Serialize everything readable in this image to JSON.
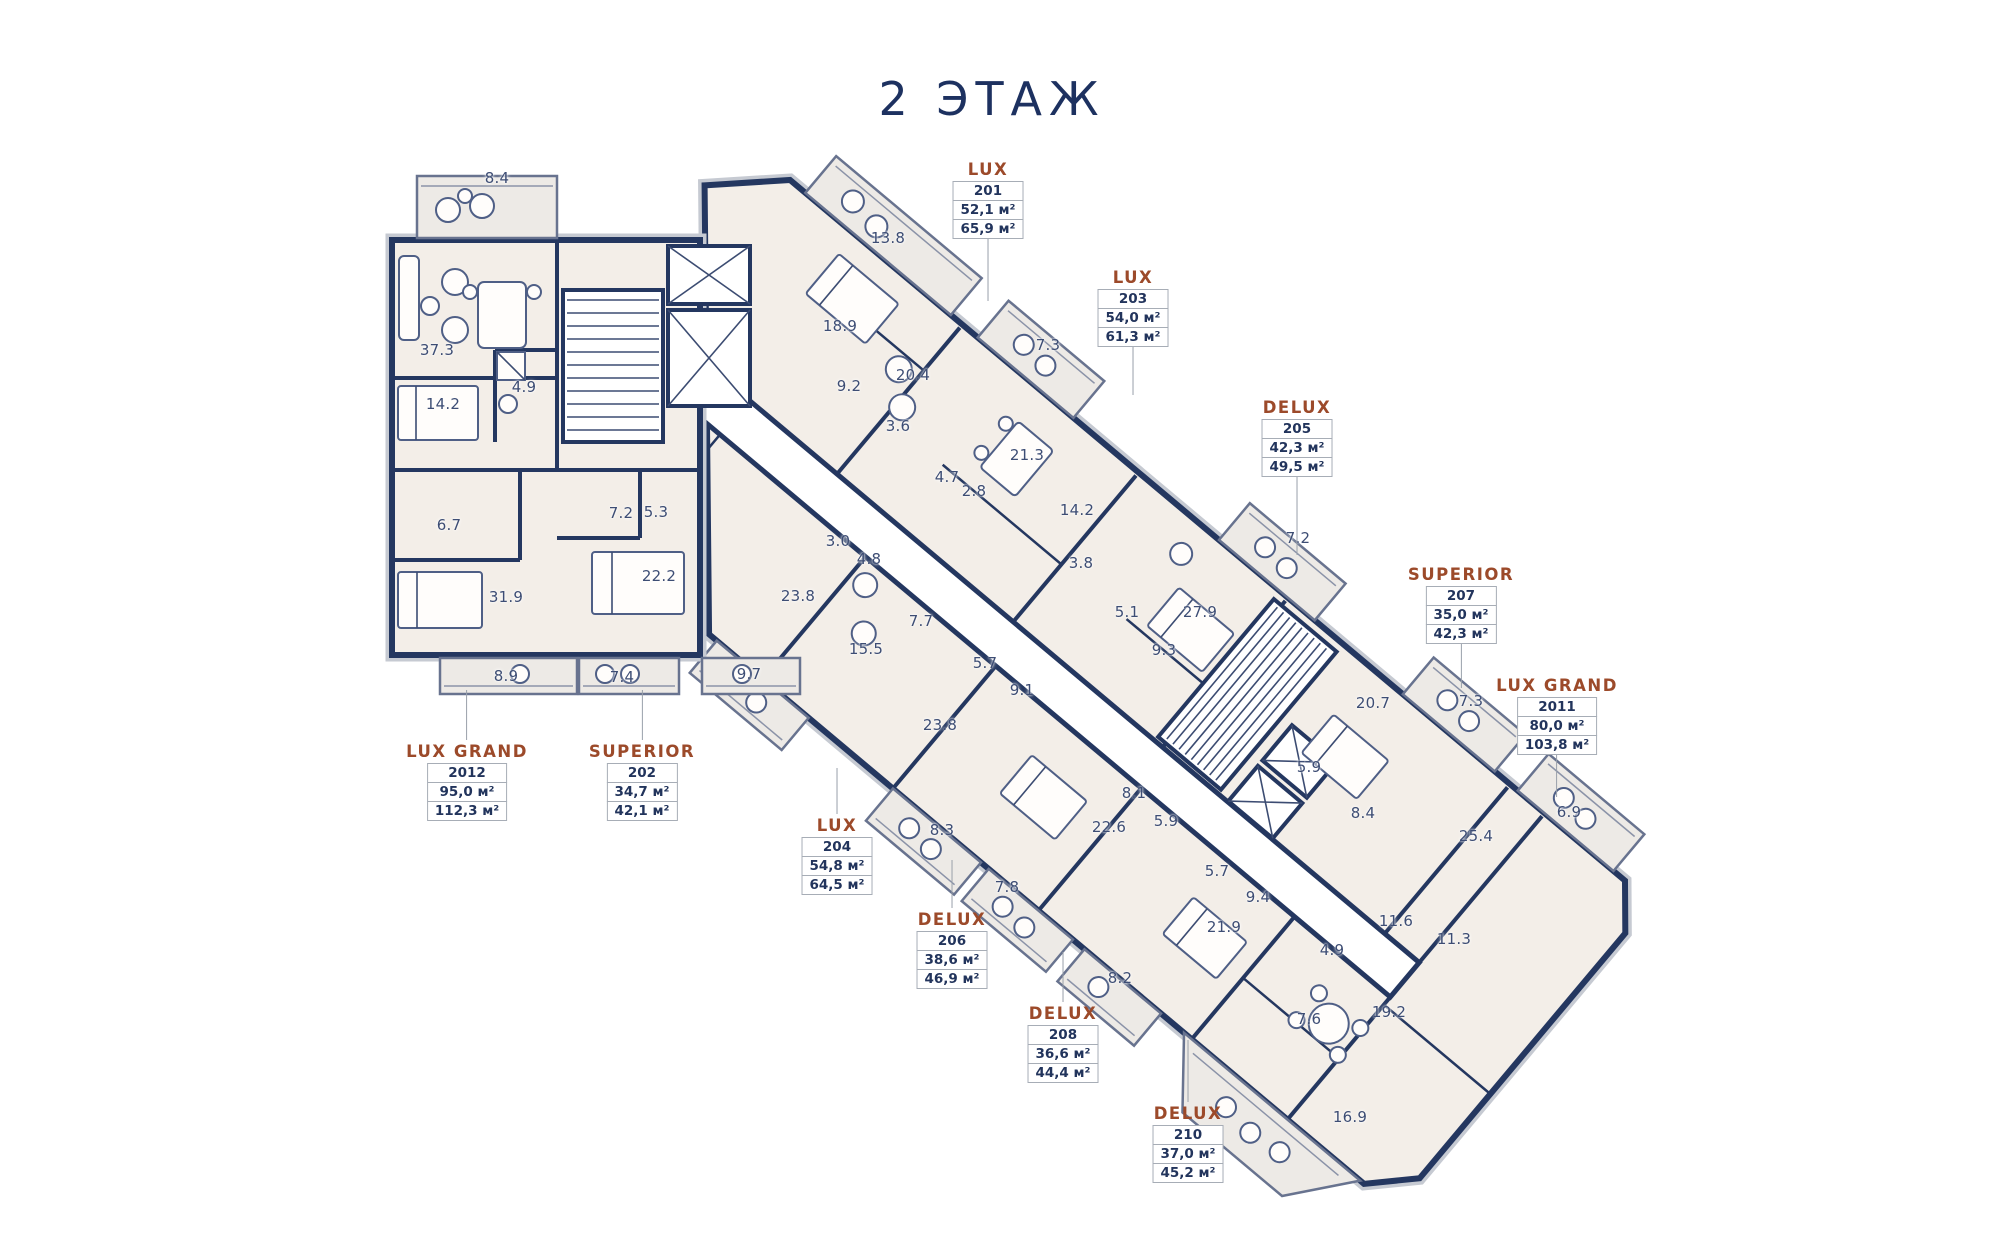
{
  "title": "2 ЭТАЖ",
  "plan": {
    "colors": {
      "wall_navy": "#243760",
      "room_fill": "#f3eee8",
      "balcony_fill": "#edeae6",
      "corridor_fill": "#ffffff",
      "unit_type_brown": "#9c4a2a",
      "number_navy": "#22345c",
      "leader_gray": "#99a0aa"
    },
    "units": [
      {
        "type": "LUX",
        "number": "201",
        "area1": "52,1 м²",
        "area2": "65,9 м²",
        "cx": 988,
        "top": 158,
        "dir": "down",
        "leader": 62
      },
      {
        "type": "LUX",
        "number": "203",
        "area1": "54,0 м²",
        "area2": "61,3 м²",
        "cx": 1133,
        "top": 266,
        "dir": "down",
        "leader": 48
      },
      {
        "type": "DELUX",
        "number": "205",
        "area1": "42,3 м²",
        "area2": "49,5 м²",
        "cx": 1297,
        "top": 396,
        "dir": "down",
        "leader": 78
      },
      {
        "type": "SUPERIOR",
        "number": "207",
        "area1": "35,0 м²",
        "area2": "42,3 м²",
        "cx": 1461,
        "top": 563,
        "dir": "down",
        "leader": 44
      },
      {
        "type": "LUX GRAND",
        "number": "2011",
        "area1": "80,0 м²",
        "area2": "103,8 м²",
        "cx": 1557,
        "top": 674,
        "dir": "down",
        "leader": 42
      },
      {
        "type": "LUX GRAND",
        "number": "2012",
        "area1": "95,0 м²",
        "area2": "112,3 м²",
        "cx": 467,
        "top": 690,
        "dir": "up",
        "leader": 50
      },
      {
        "type": "SUPERIOR",
        "number": "202",
        "area1": "34,7 м²",
        "area2": "42,1 м²",
        "cx": 642,
        "top": 690,
        "dir": "up",
        "leader": 50
      },
      {
        "type": "LUX",
        "number": "204",
        "area1": "54,8 м²",
        "area2": "64,5 м²",
        "cx": 837,
        "top": 768,
        "dir": "up",
        "leader": 46
      },
      {
        "type": "DELUX",
        "number": "206",
        "area1": "38,6 м²",
        "area2": "46,9 м²",
        "cx": 952,
        "top": 860,
        "dir": "up",
        "leader": 48
      },
      {
        "type": "DELUX",
        "number": "208",
        "area1": "36,6 м²",
        "area2": "44,4 м²",
        "cx": 1063,
        "top": 952,
        "dir": "up",
        "leader": 50
      },
      {
        "type": "DELUX",
        "number": "210",
        "area1": "37,0 м²",
        "area2": "45,2 м²",
        "cx": 1188,
        "top": 1040,
        "dir": "up",
        "leader": 62
      }
    ],
    "rooms": [
      {
        "v": "8.4",
        "x": 497,
        "y": 178
      },
      {
        "v": "37.3",
        "x": 437,
        "y": 350
      },
      {
        "v": "14.2",
        "x": 443,
        "y": 404
      },
      {
        "v": "4.9",
        "x": 524,
        "y": 387
      },
      {
        "v": "6.7",
        "x": 449,
        "y": 525
      },
      {
        "v": "31.9",
        "x": 506,
        "y": 597
      },
      {
        "v": "8.9",
        "x": 506,
        "y": 676
      },
      {
        "v": "7.2",
        "x": 621,
        "y": 513
      },
      {
        "v": "5.3",
        "x": 656,
        "y": 512
      },
      {
        "v": "22.2",
        "x": 659,
        "y": 576
      },
      {
        "v": "7.4",
        "x": 622,
        "y": 677
      },
      {
        "v": "9.7",
        "x": 749,
        "y": 674
      },
      {
        "v": "13.8",
        "x": 888,
        "y": 238
      },
      {
        "v": "18.9",
        "x": 840,
        "y": 326
      },
      {
        "v": "9.2",
        "x": 849,
        "y": 386
      },
      {
        "v": "20.4",
        "x": 913,
        "y": 375
      },
      {
        "v": "3.6",
        "x": 898,
        "y": 426
      },
      {
        "v": "7.3",
        "x": 1048,
        "y": 345
      },
      {
        "v": "21.3",
        "x": 1027,
        "y": 455
      },
      {
        "v": "4.7",
        "x": 947,
        "y": 477
      },
      {
        "v": "2.8",
        "x": 974,
        "y": 491
      },
      {
        "v": "14.2",
        "x": 1077,
        "y": 510
      },
      {
        "v": "3.8",
        "x": 1081,
        "y": 563
      },
      {
        "v": "3.0",
        "x": 838,
        "y": 541
      },
      {
        "v": "4.8",
        "x": 869,
        "y": 559
      },
      {
        "v": "7.7",
        "x": 921,
        "y": 621
      },
      {
        "v": "15.5",
        "x": 866,
        "y": 649
      },
      {
        "v": "23.8",
        "x": 798,
        "y": 596
      },
      {
        "v": "5.7",
        "x": 985,
        "y": 663
      },
      {
        "v": "9.1",
        "x": 1022,
        "y": 690
      },
      {
        "v": "23.8",
        "x": 940,
        "y": 725
      },
      {
        "v": "5.1",
        "x": 1127,
        "y": 612
      },
      {
        "v": "9.3",
        "x": 1164,
        "y": 650
      },
      {
        "v": "27.9",
        "x": 1200,
        "y": 612
      },
      {
        "v": "7.2",
        "x": 1298,
        "y": 538
      },
      {
        "v": "20.7",
        "x": 1373,
        "y": 703
      },
      {
        "v": "7.3",
        "x": 1471,
        "y": 701
      },
      {
        "v": "5.9",
        "x": 1309,
        "y": 767
      },
      {
        "v": "8.4",
        "x": 1363,
        "y": 813
      },
      {
        "v": "25.4",
        "x": 1476,
        "y": 836
      },
      {
        "v": "6.9",
        "x": 1569,
        "y": 812
      },
      {
        "v": "8.3",
        "x": 942,
        "y": 830
      },
      {
        "v": "7.8",
        "x": 1007,
        "y": 887
      },
      {
        "v": "22.6",
        "x": 1109,
        "y": 827
      },
      {
        "v": "8.1",
        "x": 1134,
        "y": 793
      },
      {
        "v": "5.9",
        "x": 1166,
        "y": 821
      },
      {
        "v": "8.2",
        "x": 1120,
        "y": 978
      },
      {
        "v": "5.7",
        "x": 1217,
        "y": 871
      },
      {
        "v": "9.4",
        "x": 1258,
        "y": 897
      },
      {
        "v": "21.9",
        "x": 1224,
        "y": 927
      },
      {
        "v": "4.9",
        "x": 1332,
        "y": 950
      },
      {
        "v": "11.6",
        "x": 1396,
        "y": 921
      },
      {
        "v": "11.3",
        "x": 1454,
        "y": 939
      },
      {
        "v": "7.6",
        "x": 1309,
        "y": 1019
      },
      {
        "v": "19.2",
        "x": 1389,
        "y": 1012
      },
      {
        "v": "16.9",
        "x": 1350,
        "y": 1117
      }
    ]
  }
}
